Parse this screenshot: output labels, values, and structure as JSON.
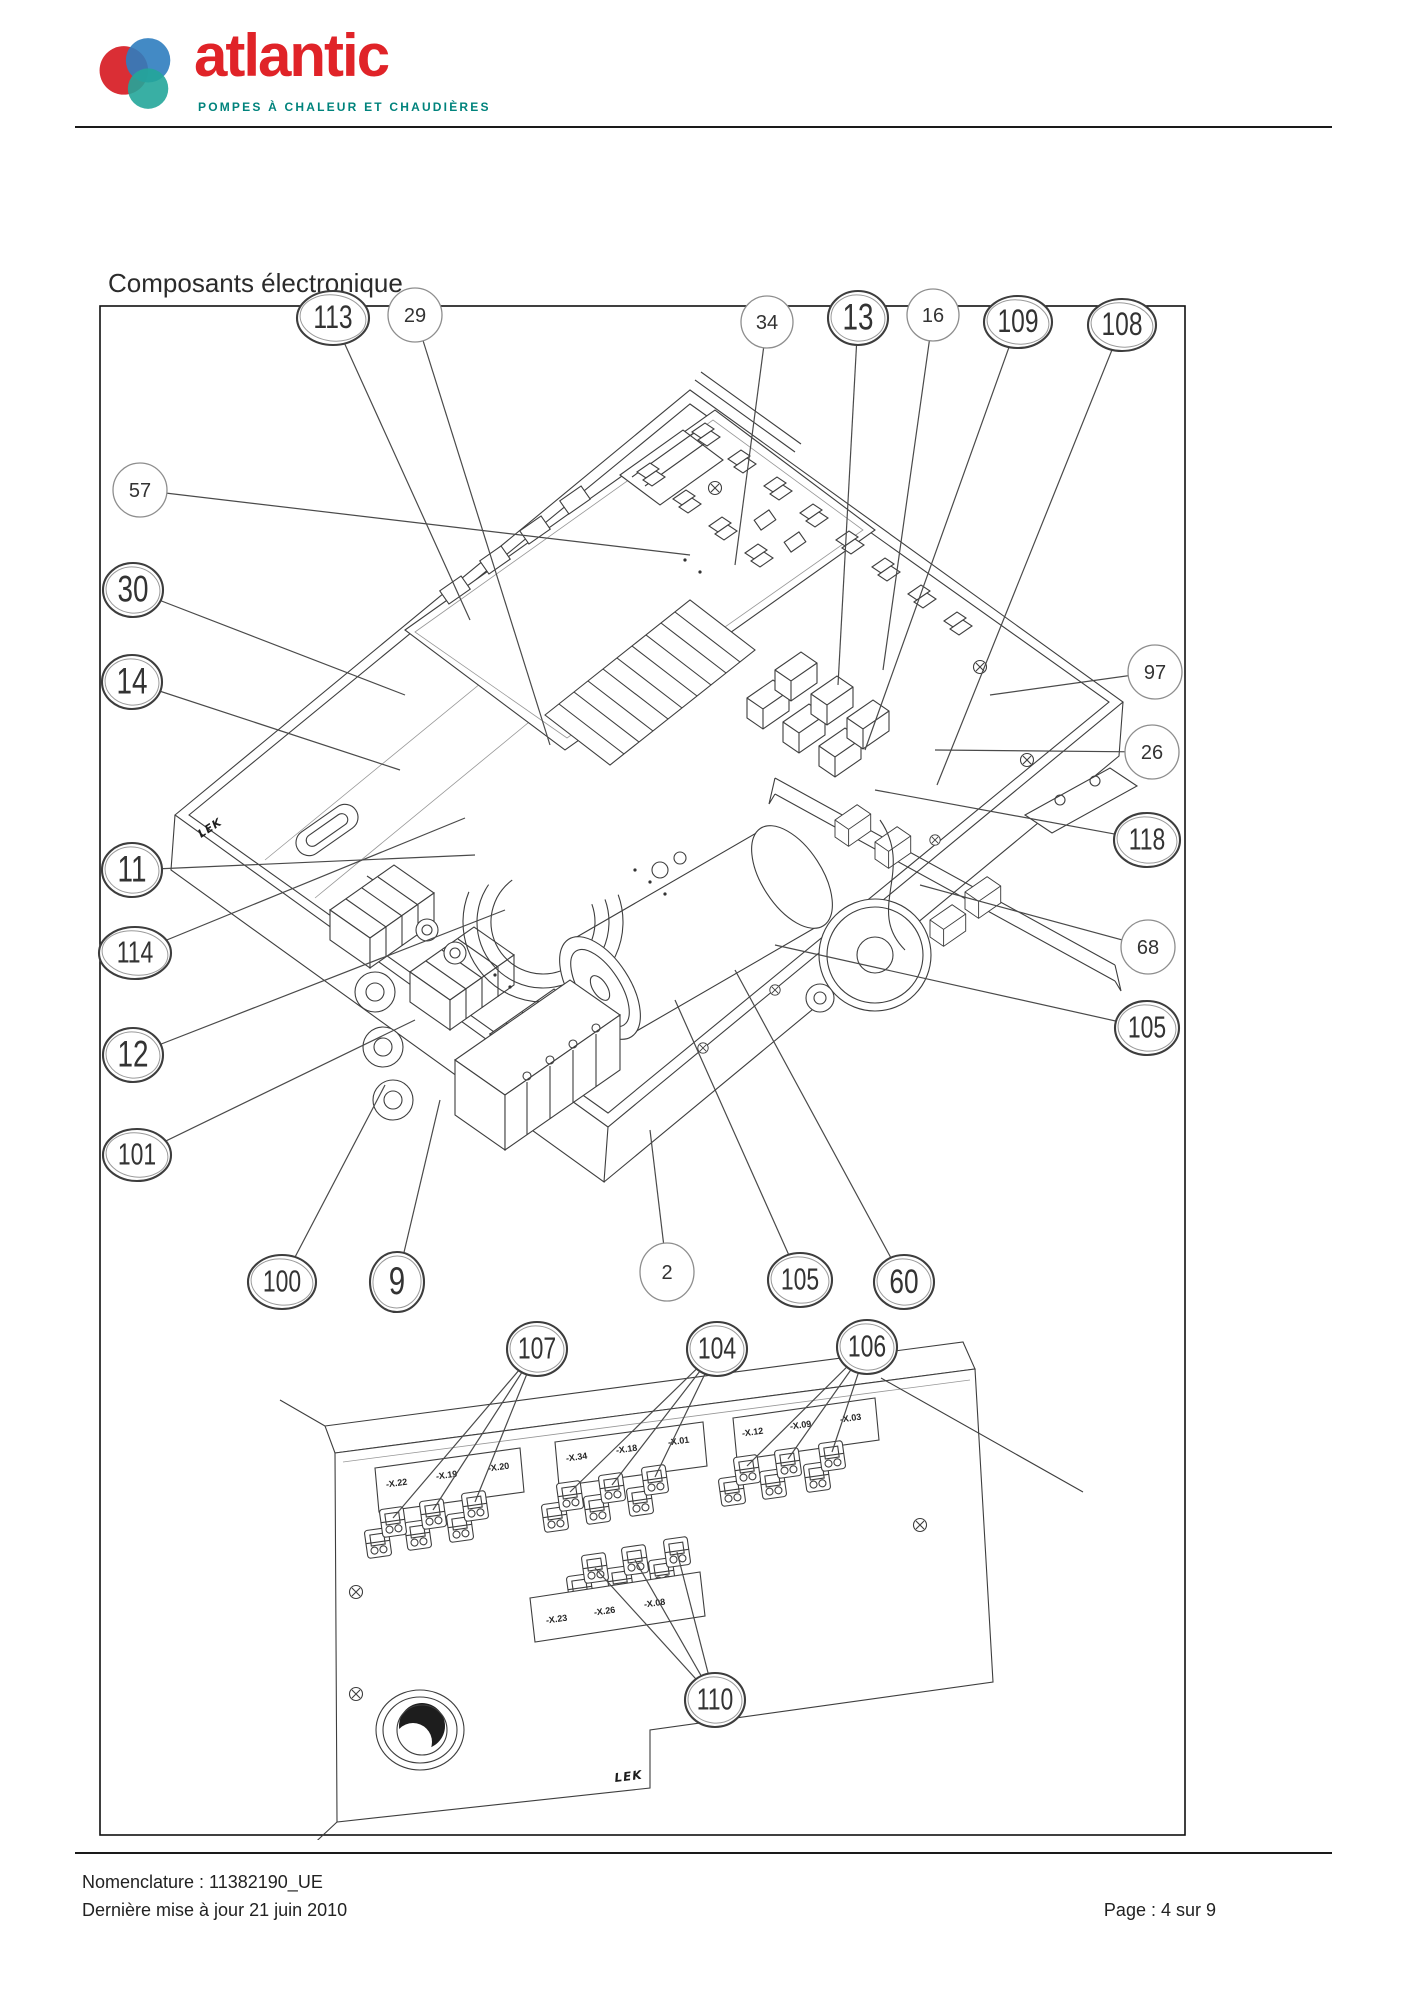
{
  "header": {
    "brand": "atlantic",
    "tagline": "POMPES À CHALEUR ET CHAUDIÈRES",
    "brand_color": "#e02328",
    "tagline_color": "#00837c",
    "logo_colors": {
      "red": "#d8232a",
      "blue": "#2f7dbf",
      "teal": "#23a69a",
      "purple": "#5b2d8e"
    }
  },
  "title": "Composants électronique",
  "figure": {
    "lek_upper": "LEK",
    "lek_lower": "LEK",
    "connector_labels_row1": [
      "-X.22",
      "-X.19",
      "-X.20",
      "-X.34",
      "-X.18",
      "-X.01",
      "-X.12",
      "-X.09",
      "-X.03"
    ],
    "connector_labels_row2": [
      "-X.23",
      "-X.26",
      "-X.08"
    ],
    "callouts": [
      {
        "n": "113",
        "style": "hand",
        "x": 258,
        "y": 88,
        "rx": 36,
        "ry": 27,
        "fs": 30,
        "lines": [
          [
            395,
            390
          ]
        ]
      },
      {
        "n": "29",
        "style": "clean",
        "x": 340,
        "y": 85,
        "rx": 27,
        "ry": 27,
        "fs": 20,
        "lines": [
          [
            475,
            515
          ]
        ]
      },
      {
        "n": "34",
        "style": "clean",
        "x": 692,
        "y": 92,
        "rx": 26,
        "ry": 26,
        "fs": 20,
        "lines": [
          [
            660,
            335
          ]
        ]
      },
      {
        "n": "13",
        "style": "hand",
        "x": 783,
        "y": 88,
        "rx": 30,
        "ry": 27,
        "fs": 34,
        "lines": [
          [
            763,
            455
          ]
        ]
      },
      {
        "n": "16",
        "style": "clean",
        "x": 858,
        "y": 85,
        "rx": 26,
        "ry": 26,
        "fs": 20,
        "lines": [
          [
            808,
            440
          ]
        ]
      },
      {
        "n": "109",
        "style": "hand",
        "x": 943,
        "y": 92,
        "rx": 34,
        "ry": 26,
        "fs": 30,
        "lines": [
          [
            790,
            520
          ]
        ]
      },
      {
        "n": "108",
        "style": "hand",
        "x": 1047,
        "y": 95,
        "rx": 34,
        "ry": 26,
        "fs": 30,
        "lines": [
          [
            862,
            555
          ]
        ]
      },
      {
        "n": "57",
        "style": "clean",
        "x": 65,
        "y": 260,
        "rx": 27,
        "ry": 27,
        "fs": 20,
        "lines": [
          [
            615,
            325
          ]
        ]
      },
      {
        "n": "30",
        "style": "hand",
        "x": 58,
        "y": 360,
        "rx": 30,
        "ry": 27,
        "fs": 34,
        "lines": [
          [
            330,
            465
          ]
        ]
      },
      {
        "n": "14",
        "style": "hand",
        "x": 57,
        "y": 452,
        "rx": 30,
        "ry": 27,
        "fs": 34,
        "lines": [
          [
            325,
            540
          ]
        ]
      },
      {
        "n": "11",
        "style": "hand",
        "x": 57,
        "y": 640,
        "rx": 30,
        "ry": 27,
        "fs": 34,
        "lines": [
          [
            400,
            625
          ]
        ]
      },
      {
        "n": "114",
        "style": "hand",
        "x": 60,
        "y": 723,
        "rx": 36,
        "ry": 26,
        "fs": 28,
        "lines": [
          [
            390,
            588
          ]
        ]
      },
      {
        "n": "12",
        "style": "hand",
        "x": 58,
        "y": 825,
        "rx": 30,
        "ry": 27,
        "fs": 34,
        "lines": [
          [
            430,
            680
          ]
        ]
      },
      {
        "n": "101",
        "style": "hand",
        "x": 62,
        "y": 925,
        "rx": 34,
        "ry": 26,
        "fs": 28,
        "lines": [
          [
            340,
            790
          ]
        ]
      },
      {
        "n": "100",
        "style": "hand",
        "x": 207,
        "y": 1052,
        "rx": 34,
        "ry": 27,
        "fs": 28,
        "lines": [
          [
            310,
            855
          ]
        ]
      },
      {
        "n": "9",
        "style": "hand",
        "x": 322,
        "y": 1052,
        "rx": 27,
        "ry": 30,
        "fs": 36,
        "lines": [
          [
            365,
            870
          ]
        ]
      },
      {
        "n": "2",
        "style": "clean",
        "x": 592,
        "y": 1042,
        "rx": 27,
        "ry": 29,
        "fs": 20,
        "lines": [
          [
            575,
            900
          ]
        ]
      },
      {
        "n": "105",
        "style": "hand",
        "x": 725,
        "y": 1050,
        "rx": 32,
        "ry": 27,
        "fs": 28,
        "lines": [
          [
            600,
            770
          ]
        ]
      },
      {
        "n": "60",
        "style": "hand",
        "x": 829,
        "y": 1052,
        "rx": 30,
        "ry": 27,
        "fs": 32,
        "lines": [
          [
            660,
            740
          ]
        ]
      },
      {
        "n": "97",
        "style": "clean",
        "x": 1080,
        "y": 442,
        "rx": 27,
        "ry": 27,
        "fs": 20,
        "lines": [
          [
            915,
            465
          ]
        ]
      },
      {
        "n": "26",
        "style": "clean",
        "x": 1077,
        "y": 522,
        "rx": 27,
        "ry": 27,
        "fs": 20,
        "lines": [
          [
            860,
            520
          ]
        ]
      },
      {
        "n": "118",
        "style": "hand",
        "x": 1072,
        "y": 610,
        "rx": 33,
        "ry": 27,
        "fs": 28,
        "lines": [
          [
            800,
            560
          ]
        ]
      },
      {
        "n": "68",
        "style": "clean",
        "x": 1073,
        "y": 717,
        "rx": 27,
        "ry": 27,
        "fs": 20,
        "lines": [
          [
            845,
            655
          ]
        ]
      },
      {
        "n": "105",
        "style": "hand",
        "x": 1072,
        "y": 798,
        "rx": 32,
        "ry": 27,
        "fs": 28,
        "lines": [
          [
            700,
            715
          ]
        ]
      },
      {
        "n": "107",
        "style": "hand",
        "x": 462,
        "y": 1119,
        "rx": 30,
        "ry": 27,
        "fs": 28,
        "lines": [
          [
            318,
            1288
          ],
          [
            358,
            1280
          ],
          [
            400,
            1272
          ]
        ]
      },
      {
        "n": "104",
        "style": "hand",
        "x": 642,
        "y": 1119,
        "rx": 30,
        "ry": 27,
        "fs": 28,
        "lines": [
          [
            495,
            1262
          ],
          [
            537,
            1255
          ],
          [
            580,
            1247
          ]
        ]
      },
      {
        "n": "106",
        "style": "hand",
        "x": 792,
        "y": 1117,
        "rx": 30,
        "ry": 27,
        "fs": 28,
        "lines": [
          [
            672,
            1236
          ],
          [
            713,
            1229
          ],
          [
            757,
            1222
          ]
        ]
      },
      {
        "n": "110",
        "style": "hand",
        "x": 640,
        "y": 1470,
        "rx": 30,
        "ry": 27,
        "fs": 28,
        "lines": [
          [
            520,
            1338
          ],
          [
            560,
            1330
          ],
          [
            602,
            1322
          ]
        ]
      }
    ]
  },
  "footer": {
    "nomenclature": "Nomenclature : 11382190_UE",
    "updated": "Dernière mise à jour 21 juin 2010",
    "page": "Page : 4 sur 9"
  }
}
